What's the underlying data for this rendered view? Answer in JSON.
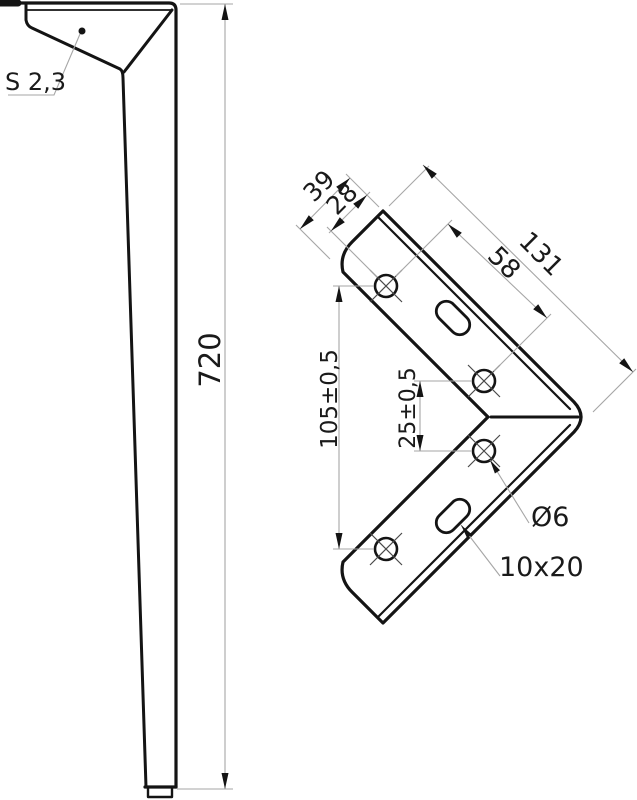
{
  "drawing": {
    "colors": {
      "background": "#ffffff",
      "outline": "#141414",
      "dimension_lines": "#a6a6a6"
    },
    "leg_view": {
      "thickness_label": "S 2,3",
      "height_label": "720"
    },
    "bracket_view": {
      "flange_width_label": "39",
      "hole_edge_offset_label": "28",
      "arm_length_label": "131",
      "hole_spacing_label": "58",
      "outer_hole_span_label": "105±0,5",
      "inner_hole_span_label": "25±0,5",
      "hole_diameter_label": "Ø6",
      "slot_size_label": "10x20"
    }
  }
}
